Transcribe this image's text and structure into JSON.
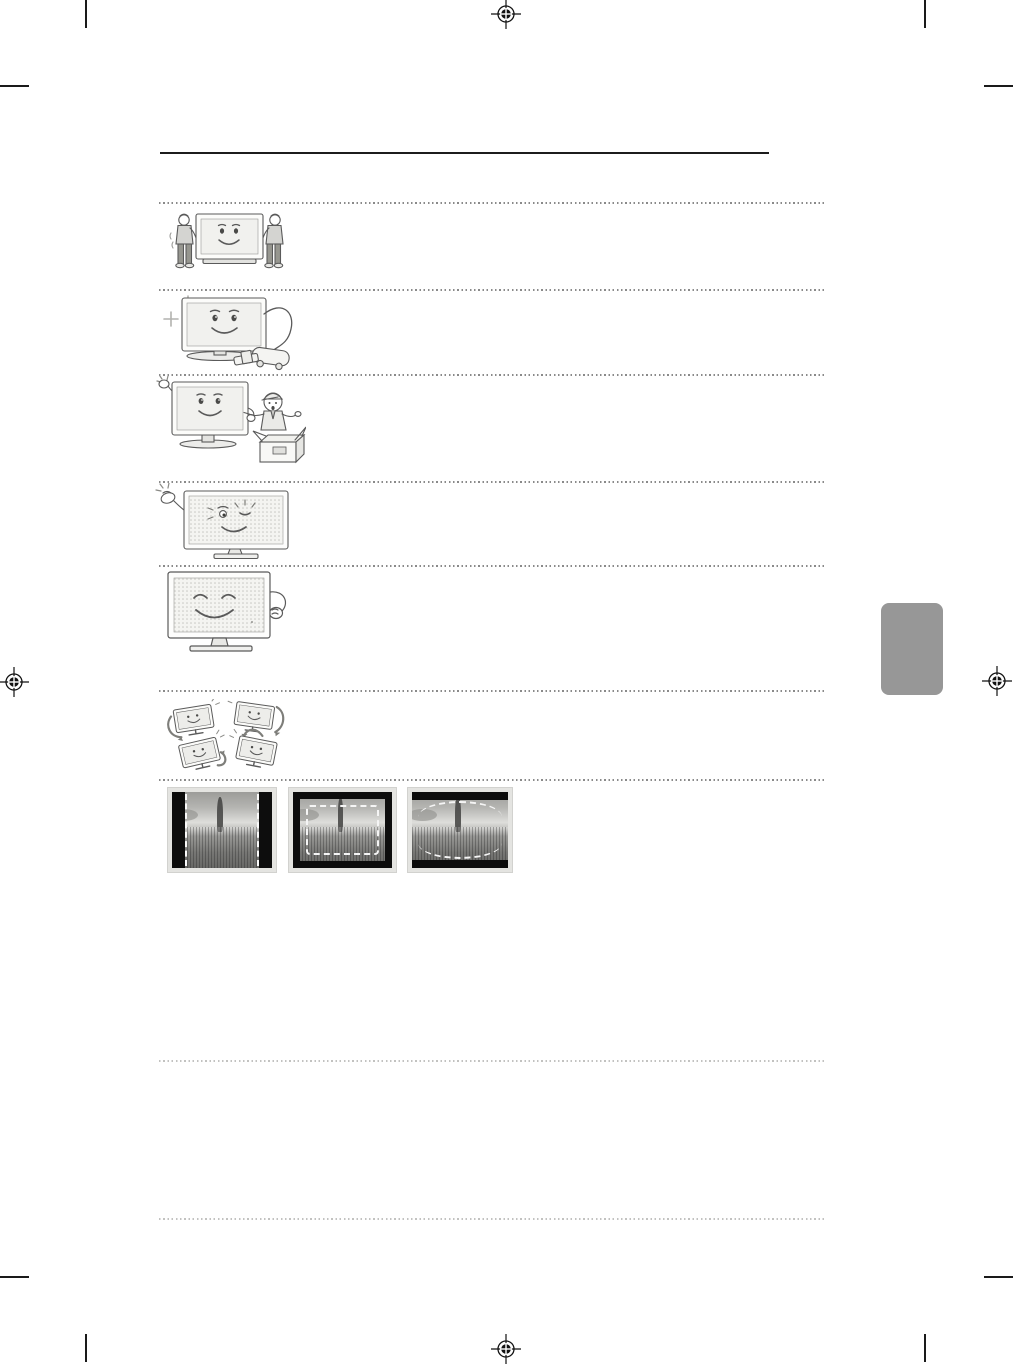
{
  "page": {
    "kind": "tv-user-manual-safety-precautions-page",
    "background": "#ffffff",
    "visible_text": ""
  },
  "printer_marks": {
    "registration_marks": [
      {
        "x": 506,
        "y": 14
      },
      {
        "x": 14,
        "y": 682
      },
      {
        "x": 997,
        "y": 681
      },
      {
        "x": 506,
        "y": 1349
      }
    ],
    "crop_marks": {
      "vertical": [
        {
          "x": 85,
          "y": 0
        },
        {
          "x": 924,
          "y": 0
        },
        {
          "x": 85,
          "y": 1334
        },
        {
          "x": 924,
          "y": 1334
        }
      ],
      "horizontal": [
        {
          "x": 0,
          "y": 85
        },
        {
          "x": 984,
          "y": 85
        },
        {
          "x": 0,
          "y": 1276
        },
        {
          "x": 984,
          "y": 1276
        }
      ],
      "color": "#1a1a1a"
    }
  },
  "rules": {
    "title_rule": {
      "x": 160,
      "y": 152,
      "width": 609,
      "color": "#1c1c1c"
    }
  },
  "separators": {
    "x": 159,
    "width": 665,
    "color_dark": "#8a8a8a",
    "color_light": "#c2c2c0",
    "lines": [
      {
        "y": 202,
        "tone": "dark"
      },
      {
        "y": 289,
        "tone": "dark"
      },
      {
        "y": 374,
        "tone": "dark"
      },
      {
        "y": 481,
        "tone": "dark"
      },
      {
        "y": 565,
        "tone": "dark"
      },
      {
        "y": 690,
        "tone": "dark"
      },
      {
        "y": 779,
        "tone": "dark"
      },
      {
        "y": 1060,
        "tone": "light"
      },
      {
        "y": 1218,
        "tone": "light"
      }
    ]
  },
  "illustrations": [
    {
      "name": "two-people-carrying-tv"
    },
    {
      "name": "tv-with-vacuum-cleaner"
    },
    {
      "name": "tv-waving-with-serviceman-and-box"
    },
    {
      "name": "winking-tv-with-snapping-hand"
    },
    {
      "name": "resting-tv-with-arm"
    },
    {
      "name": "four-tilted-tvs-with-rotation-arrows"
    }
  ],
  "screen_mode_examples": [
    {
      "name": "pillarbox-side-black-bars"
    },
    {
      "name": "windowbox-black-frame"
    },
    {
      "name": "letterbox-top-bottom-black-bars"
    }
  ],
  "side_tab": {
    "x": 881,
    "y": 603,
    "width": 62,
    "height": 92,
    "color": "#979797"
  }
}
